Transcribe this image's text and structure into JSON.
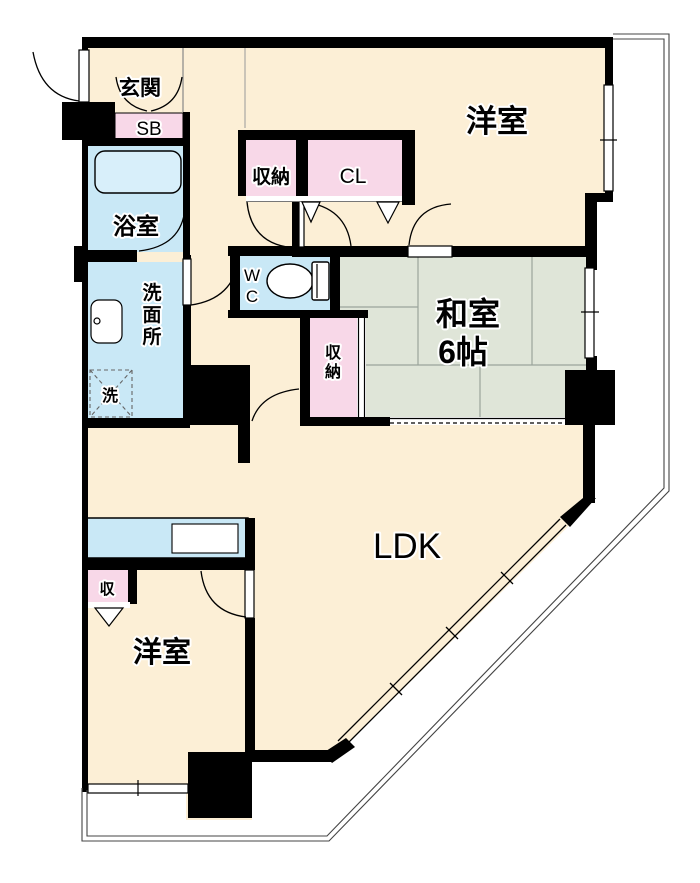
{
  "plan": {
    "type": "apartment-floor-plan"
  },
  "colors": {
    "cream": "#FCEFD6",
    "water_blue": "#C9E8F6",
    "tub_blue": "#D8EFFA",
    "pink": "#F8D8E8",
    "tatami_green": "#DFE5D8",
    "wall": "#000000",
    "balcony_line": "#444444",
    "grid_line": "#9aa39b"
  },
  "rooms": {
    "genkan": {
      "label": "玄関"
    },
    "shoe_box": {
      "label": "SB"
    },
    "bathroom": {
      "label": "浴室"
    },
    "washroom": {
      "label": "洗面所",
      "chars": [
        "洗",
        "面",
        "所"
      ]
    },
    "washer": {
      "label": "洗"
    },
    "wc": {
      "label": "WC",
      "chars": [
        "W",
        "C"
      ]
    },
    "storage_hall": {
      "label": "収納"
    },
    "closet": {
      "label": "CL"
    },
    "storage_mid": {
      "label": "収納",
      "chars": [
        "収",
        "納"
      ]
    },
    "washitsu": {
      "name_line": "和室",
      "size_line": "6帖"
    },
    "western_top": {
      "label": "洋室"
    },
    "ldk": {
      "label": "LDK"
    },
    "storage_bottom": {
      "label": "収"
    },
    "western_bottom": {
      "label": "洋室"
    }
  }
}
